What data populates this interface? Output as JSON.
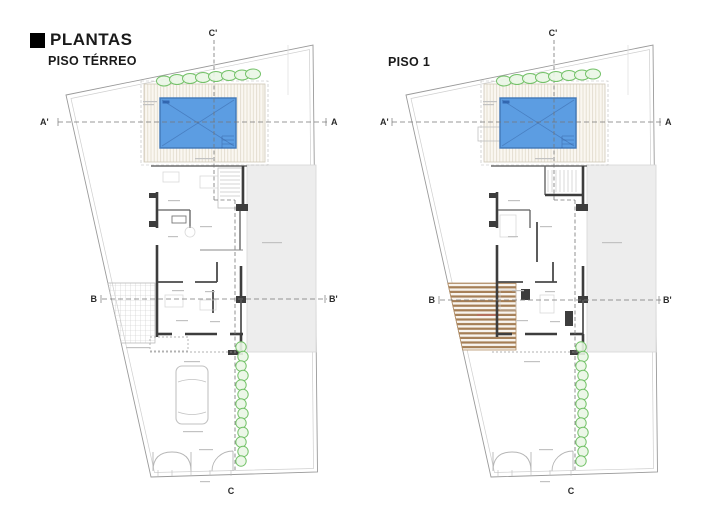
{
  "title_block": {
    "title": "PLANTAS",
    "icon": "black-square"
  },
  "plans": [
    {
      "name": "PISO TÉRREO",
      "labels": {
        "a_start": "A'",
        "a_end": "A",
        "b_start": "B",
        "b_end": "B'",
        "c_top": "C'",
        "c_bottom": "C"
      },
      "features": [
        "pool",
        "pool-deck-hatch",
        "hedge-top",
        "hedge-side",
        "neighbor-building",
        "grid-paving",
        "car",
        "entrance-gates",
        "house-walls"
      ]
    },
    {
      "name": "PISO 1",
      "labels": {
        "a_start": "A'",
        "a_end": "A",
        "b_start": "B",
        "b_end": "B'",
        "c_top": "C'",
        "c_bottom": "C"
      },
      "features": [
        "pool",
        "pool-deck-hatch",
        "hedge-top",
        "hedge-side",
        "neighbor-building",
        "wood-deck",
        "entrance-gates",
        "house-walls",
        "stairs"
      ]
    }
  ],
  "colors": {
    "pool": "#5C9DE2",
    "pool_edge": "#4178B8",
    "hedge": "#74C269",
    "hedge_fill": "#EAF6E6",
    "wood_deck": "#A57E55",
    "neighbor": "#EDEDED",
    "wall": "#3D3D3D",
    "section_line": "#777777"
  }
}
